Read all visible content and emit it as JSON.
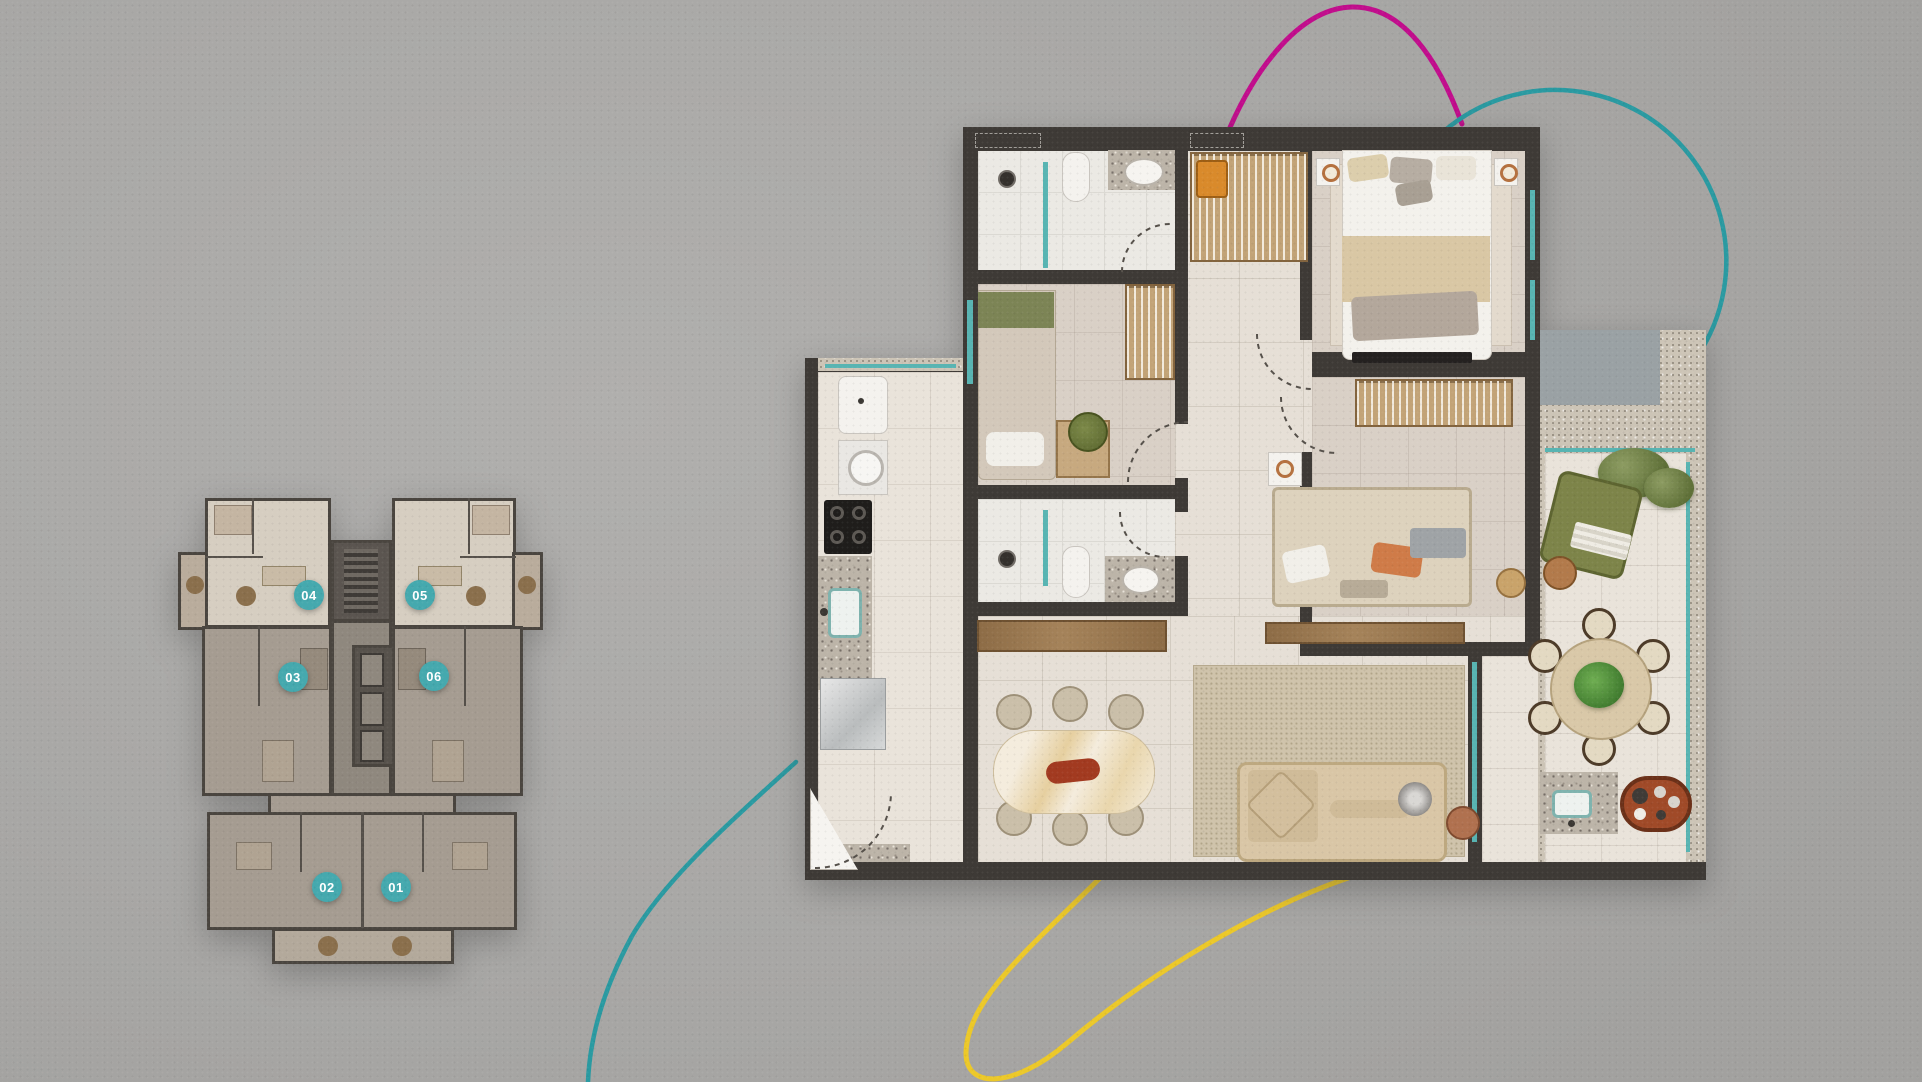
{
  "scene": {
    "description": "residential floor plan marketing graphic",
    "background": "#a9a8a6"
  },
  "key_plan": {
    "units": [
      {
        "label": "04",
        "cx": 309,
        "cy": 595
      },
      {
        "label": "05",
        "cx": 420,
        "cy": 595
      },
      {
        "label": "03",
        "cx": 293,
        "cy": 677
      },
      {
        "label": "06",
        "cx": 434,
        "cy": 676
      },
      {
        "label": "02",
        "cx": 327,
        "cy": 887
      },
      {
        "label": "01",
        "cx": 396,
        "cy": 887
      }
    ],
    "badge": {
      "color": "#45a9ae",
      "text_color": "#ffffff",
      "diameter": 30
    }
  },
  "curves": {
    "magenta": {
      "color": "#c10d8c"
    },
    "teal": {
      "color": "#2a9aa1"
    },
    "yellow": {
      "color": "#ecc829"
    }
  },
  "palette": {
    "wall": "#3e3a36",
    "floor_tile": "#ebe9e4",
    "floor_warm": "#d9d0c6",
    "floor_living": "#e6dfd6",
    "wood": "#9a7950",
    "wardrobe": "#c2a377",
    "sofa": "#d9c6a6",
    "rug": "#cfc3ab",
    "plant_green": "#6f7d44",
    "glass": "#58b4b2",
    "granite": "#bcb4a8"
  }
}
